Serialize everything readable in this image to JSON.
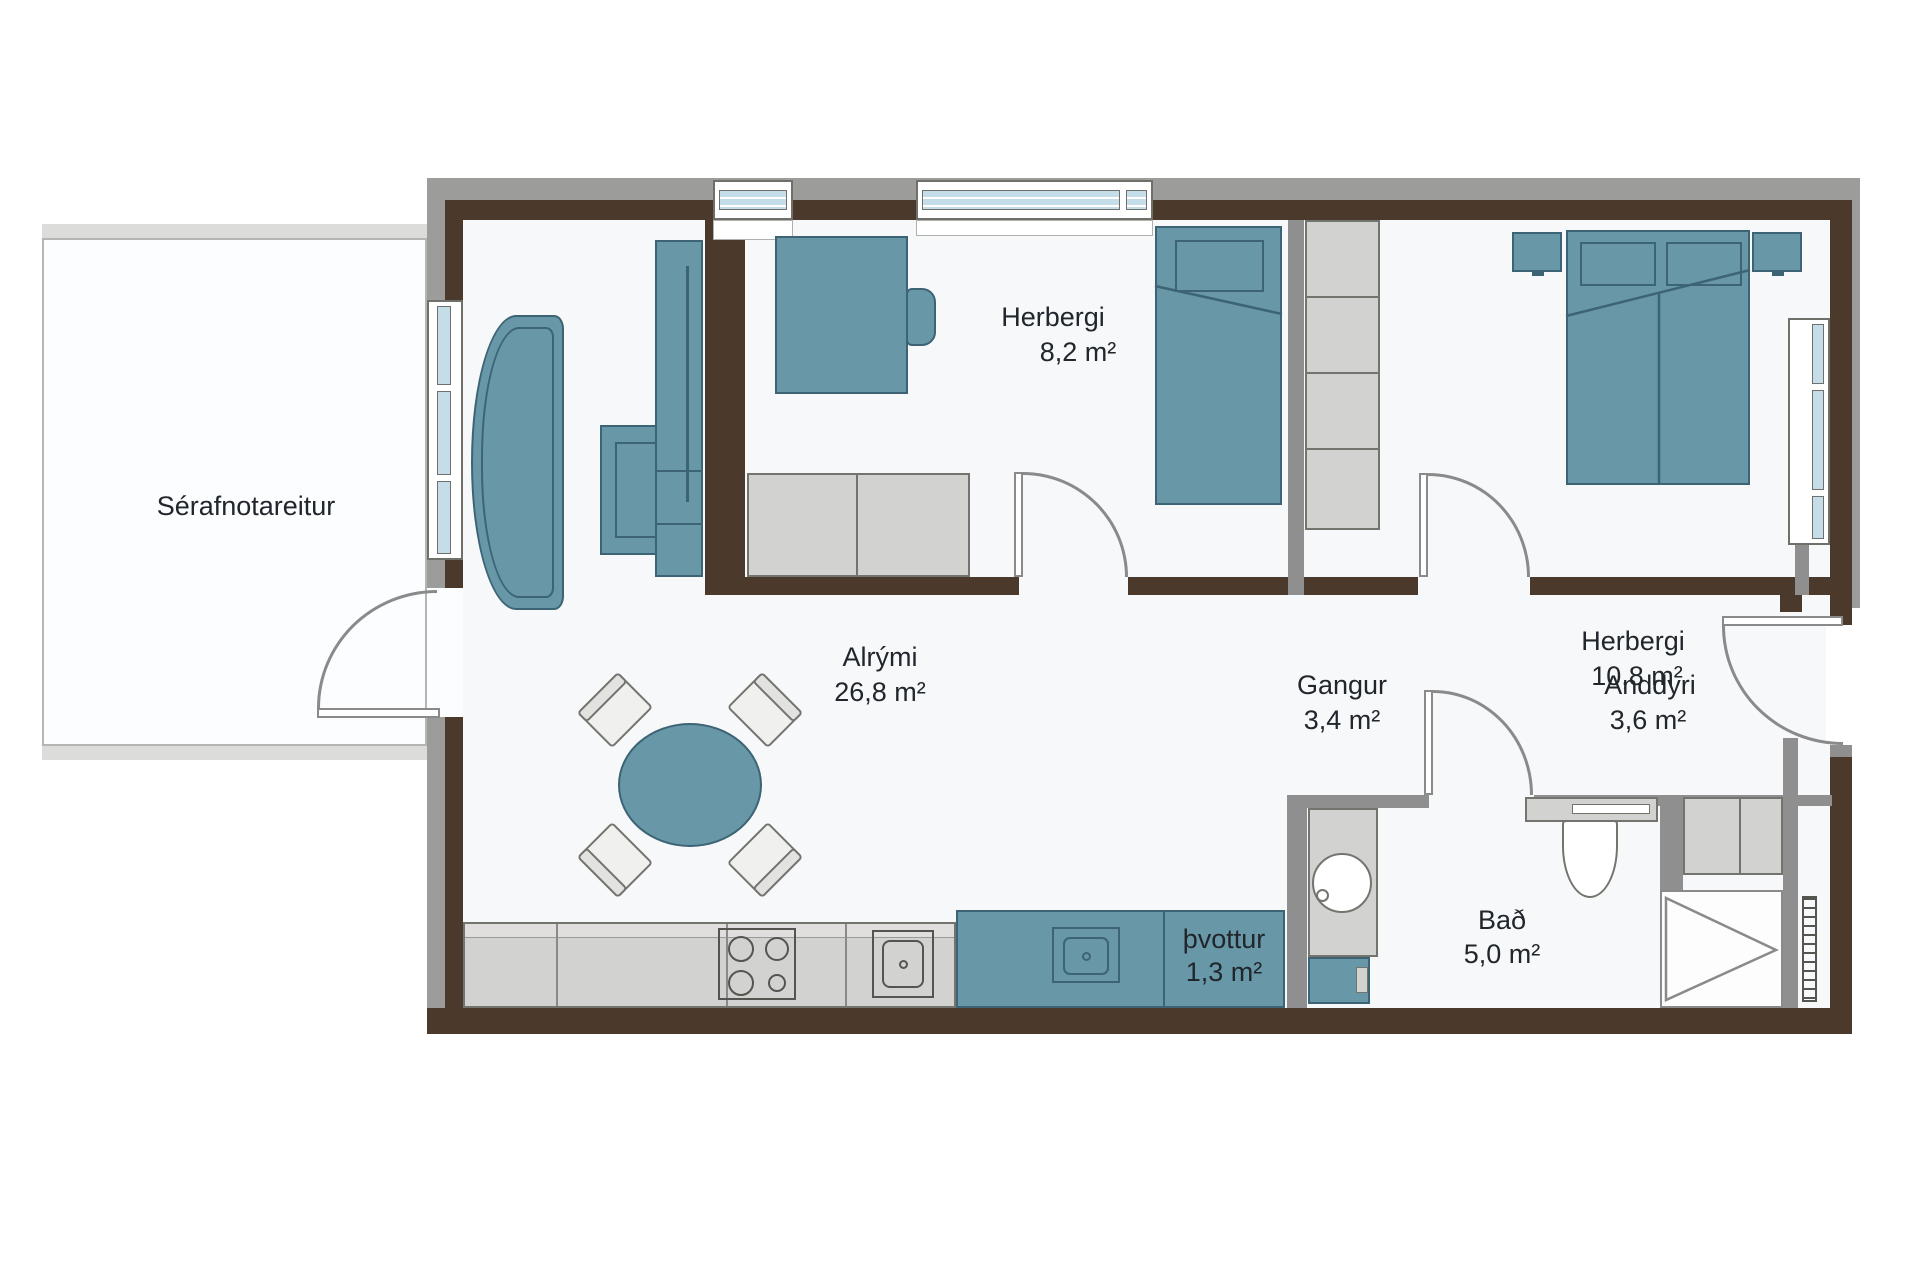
{
  "title": "Apartment floor plan",
  "rooms": [
    {
      "name": "Sérafnotareitur",
      "area": ""
    },
    {
      "name": "Alrými",
      "area": "26,8 m²"
    },
    {
      "name": "Herbergi",
      "area": "8,2 m²"
    },
    {
      "name": "Herbergi",
      "area": "10,8 m²"
    },
    {
      "name": "Gangur",
      "area": "3,4 m²"
    },
    {
      "name": "Anddyri",
      "area": "3,6 m²"
    },
    {
      "name": "Bað",
      "area": "5,0 m²"
    },
    {
      "name": "þvottur",
      "area": "1,3 m²"
    }
  ],
  "furniture_icons": [
    "curved-sofa-icon",
    "coffee-table-icon",
    "tv-sideboard-icon",
    "round-dining-table-icon",
    "dining-chair-icon",
    "desk-icon",
    "desk-chair-icon",
    "single-bed-icon",
    "double-bed-icon",
    "nightstand-icon",
    "wardrobe-column-icon",
    "corner-cabinet-icon",
    "kitchen-counter-icon",
    "stove-icon",
    "kitchen-sink-icon",
    "laundry-sink-icon",
    "washing-machine-icon",
    "vanity-basin-icon",
    "toilet-icon",
    "shower-icon",
    "radiator-icon",
    "entry-closet-icon",
    "window-icon",
    "door-swing-icon"
  ],
  "colors": {
    "teal": "#6897A7",
    "teal-dark": "#3C6474",
    "wall-brown": "#4B3A2B",
    "wall-gray": "#9C9C9A",
    "wall-mid": "#8F8F8F",
    "cabinet": "#D2D2D0",
    "cabinet-line": "#74746F",
    "glass": "#C5DDE8",
    "frame-line": "#70706B",
    "floor": "#F6F8FA",
    "patio-line": "#B5B5B3",
    "patio-band": "#DCDCDA",
    "arc": "#8A8A8A",
    "ink": "#20262B"
  }
}
